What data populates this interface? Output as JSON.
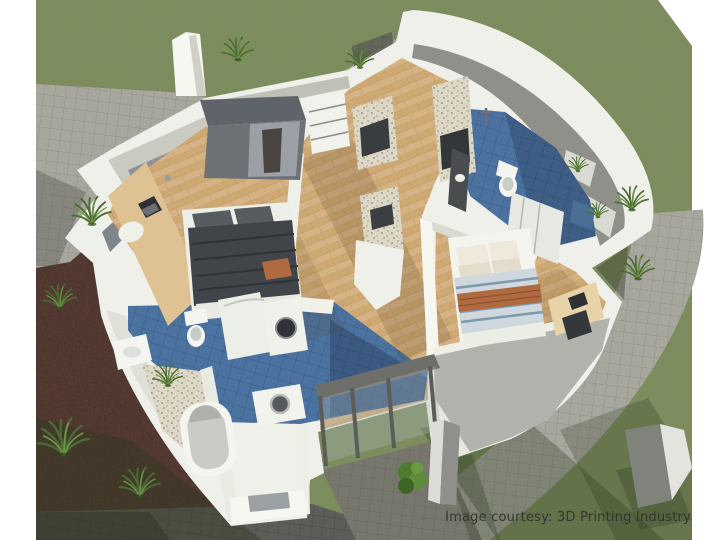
{
  "image": {
    "type": "3d-architectural-render",
    "description": "Aerial cutaway view of a curved 3D-printed house floor plan with two furnished bedrooms, two blue-tiled bathrooms, a kitchen and hallway, surrounded by lawn, gray paving, dark mulch beds and spiky ornamental plants",
    "visible_elements": [
      "lawn",
      "driveway paving",
      "curved walkway",
      "mulch garden bed",
      "ornamental grass plants",
      "bush",
      "fence posts",
      "white printed walls",
      "left bedroom",
      "right bedroom",
      "left bathroom",
      "right bathroom",
      "kitchen",
      "hallway",
      "entry porch with glass door",
      "bathtub",
      "washing machine",
      "toilets",
      "beds",
      "wardrobes",
      "desks with laptops"
    ]
  },
  "caption": {
    "text": "Image courtesy: 3D Printing Industry"
  },
  "colors": {
    "page_background": "#ffffff",
    "grass": "#7d8c5e",
    "grass_shadow": "#2c3a20",
    "paving": "#a8a79e",
    "paving_dark": "#5c5c58",
    "mulch": "#49302a",
    "wall_white": "#eef0e9",
    "wall_bright": "#f6f7f1",
    "wall_shade": "#b2b3ad",
    "wall_inner": "#8e9089",
    "wood_floor": "#d6b384",
    "wood_dark": "#b98f5e",
    "tile_blue": "#4c72a0",
    "tile_grout": "#3a5d88",
    "terrazzo": "#ddd7c6",
    "bed_charcoal": "#41454a",
    "furniture_gray": "#6e7277",
    "accent_rust": "#b06a42",
    "plant_green": "#4a6b33",
    "caption_text": "#32322e"
  }
}
